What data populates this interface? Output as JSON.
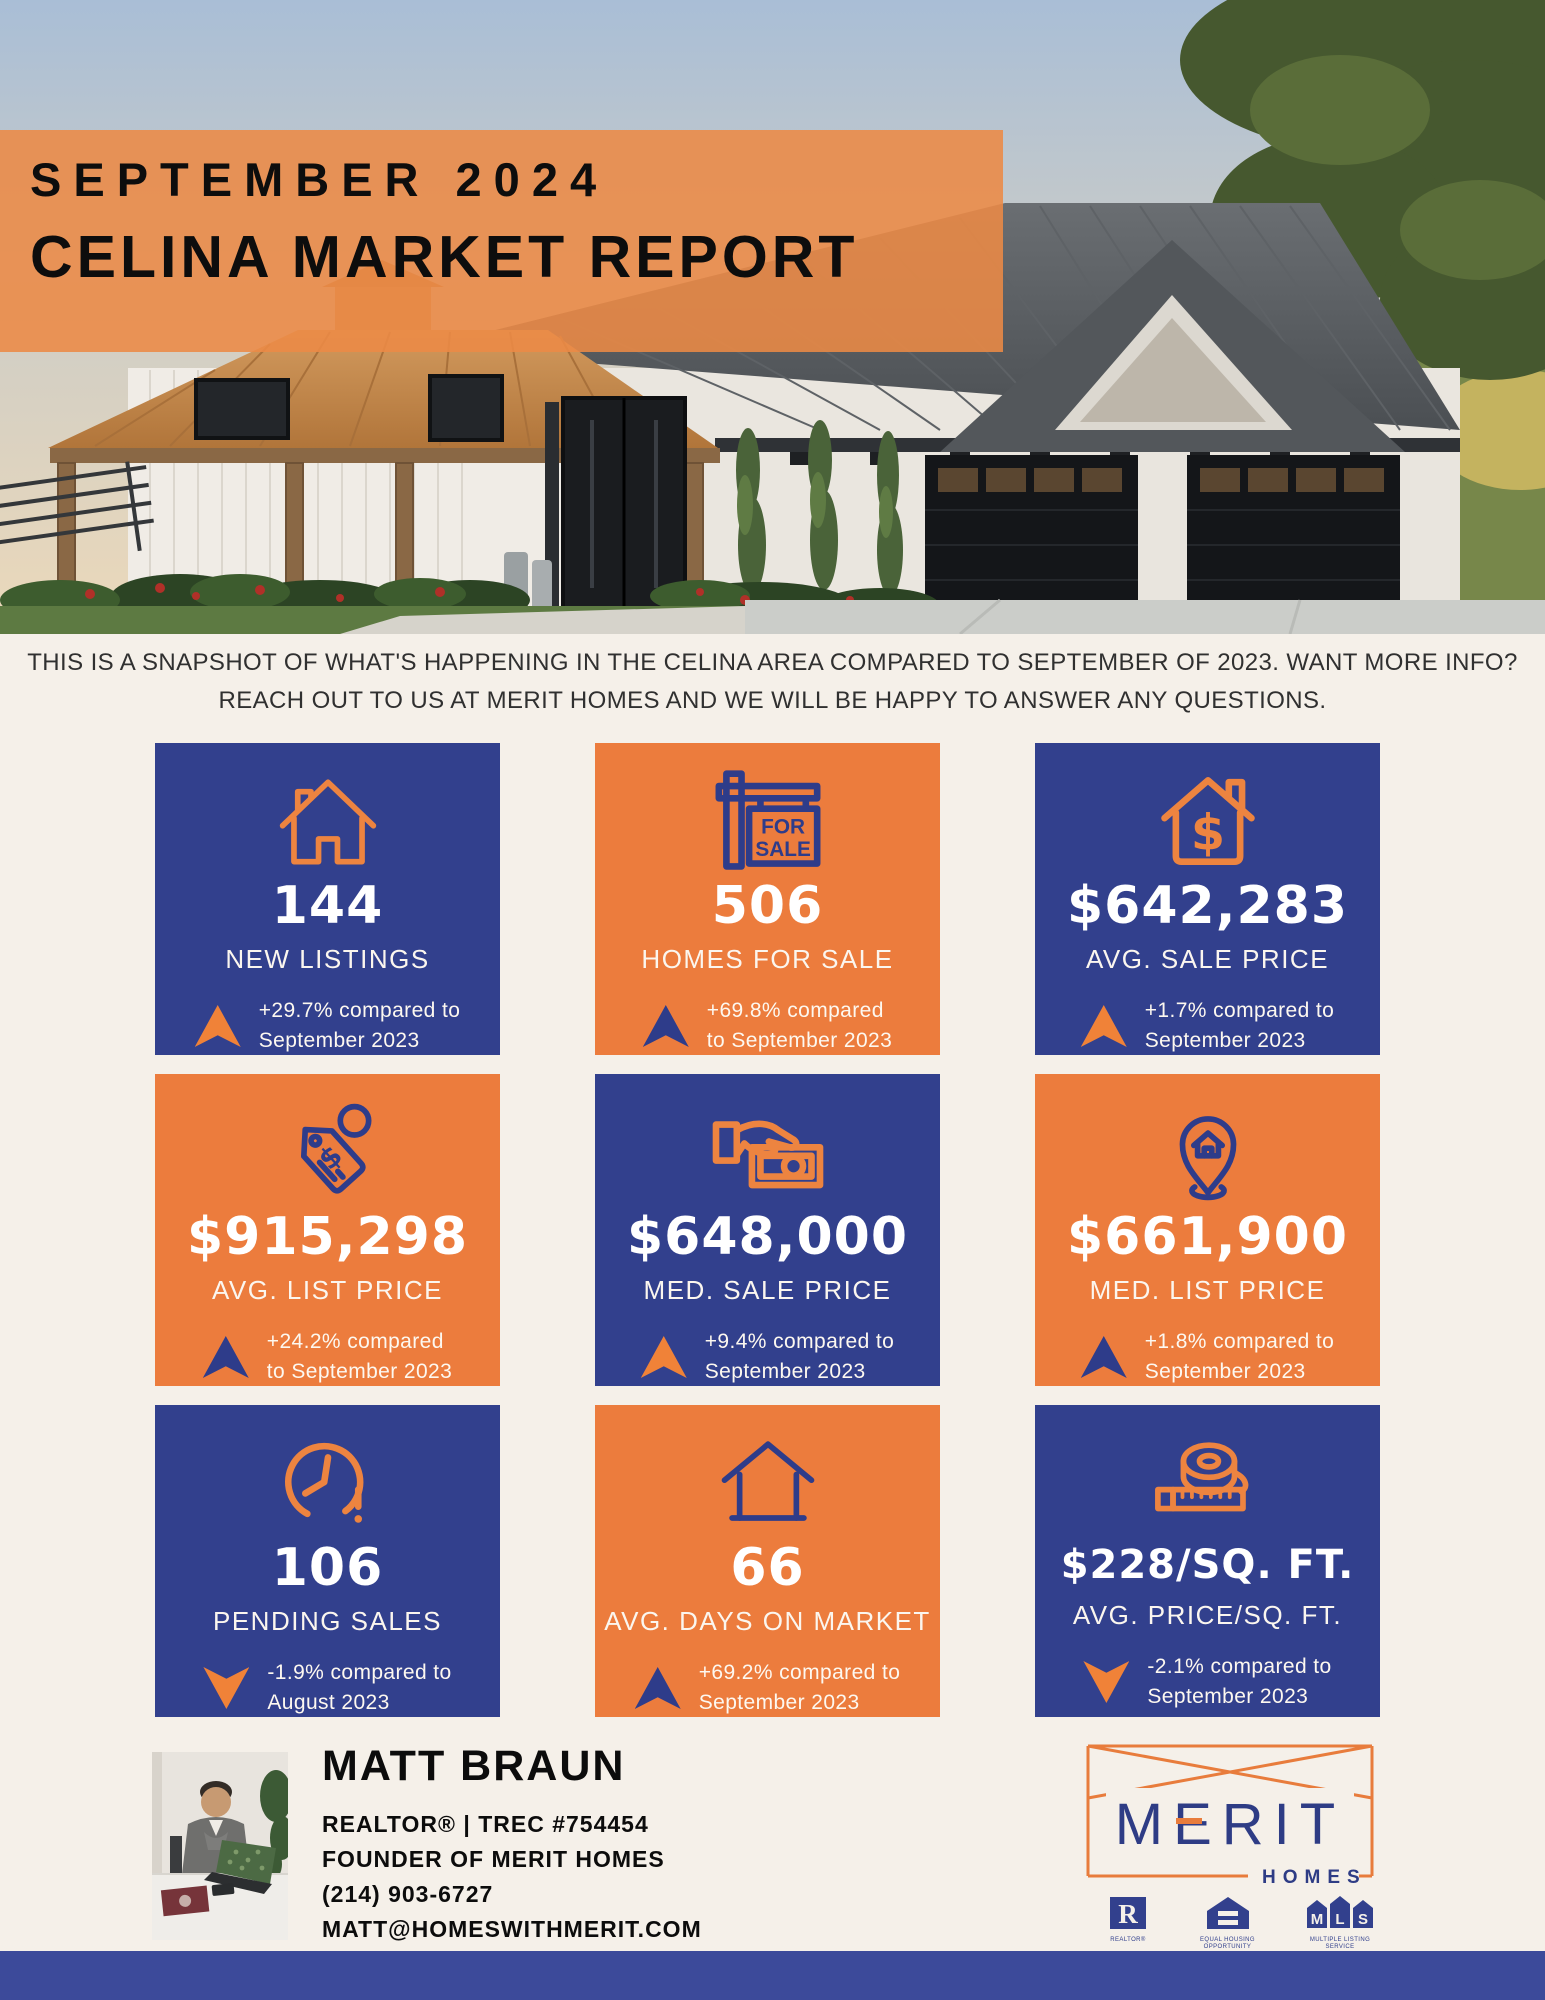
{
  "header": {
    "date": "SEPTEMBER 2024",
    "title": "CELINA MARKET REPORT"
  },
  "intro": {
    "line1": "THIS IS A SNAPSHOT OF WHAT'S HAPPENING IN THE CELINA AREA COMPARED TO SEPTEMBER OF 2023. WANT MORE INFO?",
    "line2": "REACH OUT TO US AT MERIT HOMES AND WE WILL BE HAPPY TO ANSWER ANY QUESTIONS."
  },
  "for_sale_sign": {
    "line1": "FOR",
    "line2": "SALE"
  },
  "cards": [
    {
      "icon": "house-icon",
      "theme": "navy",
      "value": "144",
      "label": "NEW LISTINGS",
      "direction": "up",
      "delta_line1": "+29.7% compared to",
      "delta_line2": "September 2023"
    },
    {
      "icon": "for-sale-sign-icon",
      "theme": "orange",
      "value": "506",
      "label": "HOMES FOR SALE",
      "direction": "up",
      "delta_line1": "+69.8% compared",
      "delta_line2": "to September 2023"
    },
    {
      "icon": "house-dollar-icon",
      "theme": "navy",
      "value": "$642,283",
      "label": "AVG. SALE PRICE",
      "direction": "up",
      "delta_line1": "+1.7% compared to",
      "delta_line2": "September 2023"
    },
    {
      "icon": "price-tag-icon",
      "theme": "orange",
      "value": "$915,298",
      "label": "AVG. LIST PRICE",
      "direction": "up",
      "delta_line1": "+24.2% compared",
      "delta_line2": "to September 2023"
    },
    {
      "icon": "hand-money-icon",
      "theme": "navy",
      "value": "$648,000",
      "label": "MED. SALE PRICE",
      "direction": "up",
      "delta_line1": "+9.4% compared to",
      "delta_line2": "September 2023"
    },
    {
      "icon": "location-pin-house-icon",
      "theme": "orange",
      "value": "$661,900",
      "label": "MED. LIST PRICE",
      "direction": "up",
      "delta_line1": "+1.8% compared to",
      "delta_line2": "September 2023"
    },
    {
      "icon": "clock-icon",
      "theme": "navy",
      "value": "106",
      "label": "PENDING SALES",
      "direction": "down",
      "delta_line1": "-1.9% compared to",
      "delta_line2": "August 2023"
    },
    {
      "icon": "house-outline-icon",
      "theme": "orange",
      "value": "66",
      "label": "AVG. DAYS ON MARKET",
      "direction": "up",
      "delta_line1": "+69.2% compared to",
      "delta_line2": "September 2023"
    },
    {
      "icon": "tape-measure-icon",
      "theme": "navy",
      "value": "$228/SQ. FT.",
      "label": "AVG. PRICE/SQ. FT.",
      "direction": "down",
      "delta_line1": "-2.1% compared to",
      "delta_line2": "September 2023"
    }
  ],
  "agent": {
    "name": "MATT BRAUN",
    "line1": "REALTOR® | TREC #754454",
    "line2": "FOUNDER OF MERIT HOMES",
    "line3": "(214) 903-6727",
    "line4": "MATT@HOMESWITHMERIT.COM"
  },
  "brand": {
    "name": "MERIT",
    "sub": "HOMES",
    "certifications": [
      "REALTOR®",
      "EQUAL HOUSING OPPORTUNITY",
      "MULTIPLE LISTING SERVICE"
    ]
  },
  "colors": {
    "navy": "#32408D",
    "orange": "#EC7C3D",
    "cream": "#F5F0E9",
    "footer_navy": "#3C4A9A",
    "arrow_orange": "#F08238"
  }
}
